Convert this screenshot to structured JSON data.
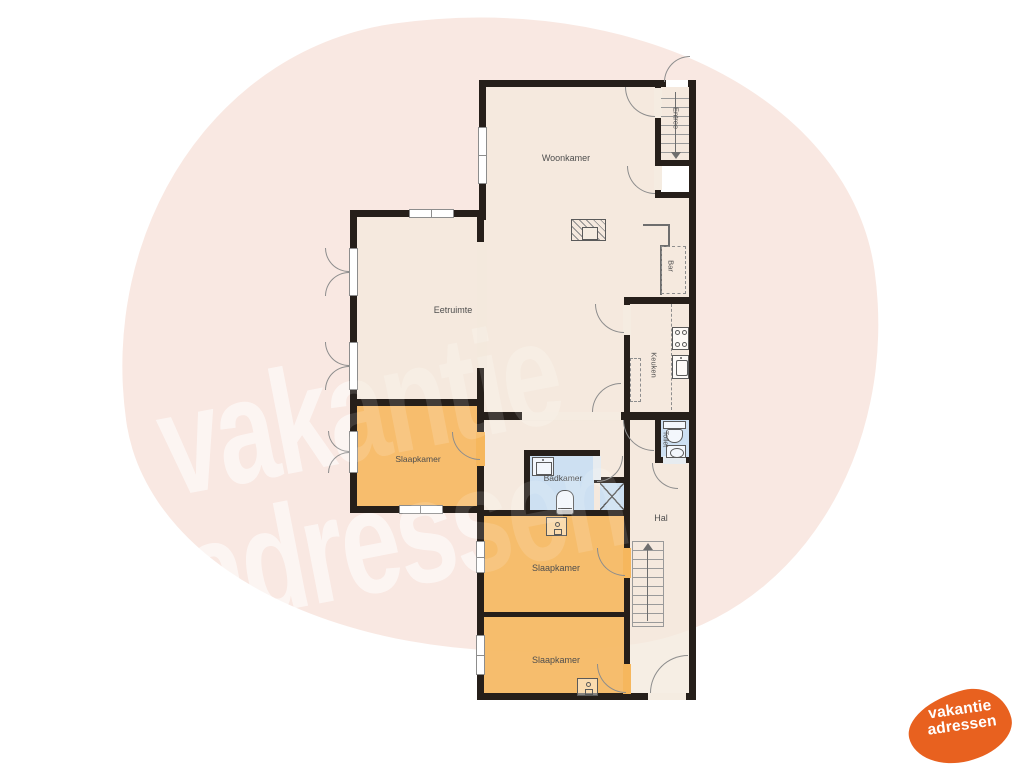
{
  "watermark": {
    "line1": "vakantie",
    "line2": "adressen"
  },
  "logo": {
    "line1": "vakantie",
    "line2": "adressen"
  },
  "plan": {
    "labels": {
      "woonkamer": "Woonkamer",
      "eetruimte": "Eetruimte",
      "slaapkamer_left": "Slaapkamer",
      "slaapkamer_mid": "Slaapkamer",
      "slaapkamer_bottom": "Slaapkamer",
      "badkamer": "Badkamer",
      "hal": "Hal",
      "keuken": "Keuken",
      "toilet": "Toilet",
      "bar": "Bar",
      "entree": "Entree"
    }
  },
  "colors": {
    "wall": "#261f1a",
    "floor_cream": "#f3e9dc",
    "floor_orange": "#f6b75d",
    "floor_blue": "#c9def3",
    "background_blob": "#f9e8e2",
    "logo_orange": "#e8611f",
    "label_text": "#4e4e4e"
  }
}
